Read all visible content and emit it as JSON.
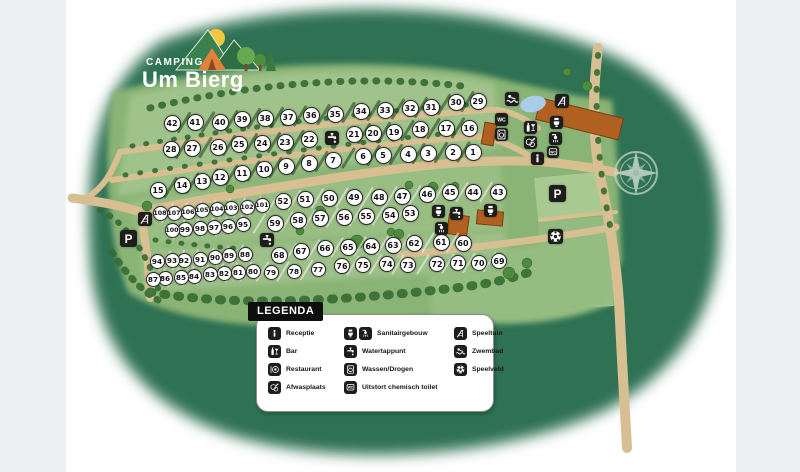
{
  "logo": {
    "camping": "CAMPING",
    "name": "Um Bierg"
  },
  "legend": {
    "title": "LEGENDA",
    "columns": [
      [
        {
          "icons": [
            "receptie"
          ],
          "label": "Receptie"
        },
        {
          "icons": [
            "bar"
          ],
          "label": "Bar"
        },
        {
          "icons": [
            "restaurant"
          ],
          "label": "Restaurant"
        },
        {
          "icons": [
            "afwasplaats"
          ],
          "label": "Afwasplaats"
        }
      ],
      [
        {
          "icons": [
            "toilet",
            "shower"
          ],
          "label": "Sanitairgebouw"
        },
        {
          "icons": [
            "watertappunt"
          ],
          "label": "Watertappunt"
        },
        {
          "icons": [
            "wassen"
          ],
          "label": "Wassen/Drogen"
        },
        {
          "icons": [
            "chemisch"
          ],
          "label": "Uitstort chemisch toilet"
        }
      ],
      [
        {
          "icons": [
            "speeltuin"
          ],
          "label": "Speeltuin"
        },
        {
          "icons": [
            "zwembad"
          ],
          "label": "Zwembad"
        },
        {
          "icons": [
            "speelveld"
          ],
          "label": "Speelveld"
        }
      ]
    ]
  },
  "colors": {
    "outer_green": "#2e7153",
    "field_green": "#8ab476",
    "road_tan": "#d7bf92",
    "building_orange": "#b06021",
    "pond_blue": "#a9cde6",
    "icon_black": "#1d1d1b"
  },
  "map": {
    "pitches": [
      {
        "n": 1,
        "x": 473,
        "y": 152
      },
      {
        "n": 2,
        "x": 453,
        "y": 152
      },
      {
        "n": 3,
        "x": 428,
        "y": 153
      },
      {
        "n": 4,
        "x": 408,
        "y": 154
      },
      {
        "n": 5,
        "x": 383,
        "y": 155
      },
      {
        "n": 6,
        "x": 363,
        "y": 156
      },
      {
        "n": 7,
        "x": 333,
        "y": 160
      },
      {
        "n": 8,
        "x": 309,
        "y": 163
      },
      {
        "n": 9,
        "x": 286,
        "y": 166
      },
      {
        "n": 10,
        "x": 264,
        "y": 169
      },
      {
        "n": 11,
        "x": 242,
        "y": 173
      },
      {
        "n": 12,
        "x": 220,
        "y": 177
      },
      {
        "n": 13,
        "x": 202,
        "y": 181
      },
      {
        "n": 14,
        "x": 182,
        "y": 185
      },
      {
        "n": 15,
        "x": 158,
        "y": 190
      },
      {
        "n": 16,
        "x": 469,
        "y": 128
      },
      {
        "n": 17,
        "x": 446,
        "y": 128
      },
      {
        "n": 18,
        "x": 420,
        "y": 129
      },
      {
        "n": 19,
        "x": 394,
        "y": 132
      },
      {
        "n": 20,
        "x": 373,
        "y": 133
      },
      {
        "n": 21,
        "x": 354,
        "y": 134
      },
      {
        "n": 22,
        "x": 309,
        "y": 139
      },
      {
        "n": 23,
        "x": 285,
        "y": 142
      },
      {
        "n": 24,
        "x": 262,
        "y": 143
      },
      {
        "n": 25,
        "x": 239,
        "y": 144
      },
      {
        "n": 26,
        "x": 218,
        "y": 147
      },
      {
        "n": 27,
        "x": 192,
        "y": 148
      },
      {
        "n": 28,
        "x": 171,
        "y": 149
      },
      {
        "n": 29,
        "x": 478,
        "y": 101
      },
      {
        "n": 30,
        "x": 456,
        "y": 102
      },
      {
        "n": 31,
        "x": 431,
        "y": 107
      },
      {
        "n": 32,
        "x": 410,
        "y": 108
      },
      {
        "n": 33,
        "x": 385,
        "y": 110
      },
      {
        "n": 34,
        "x": 361,
        "y": 111
      },
      {
        "n": 35,
        "x": 335,
        "y": 114
      },
      {
        "n": 36,
        "x": 311,
        "y": 115
      },
      {
        "n": 37,
        "x": 288,
        "y": 117
      },
      {
        "n": 38,
        "x": 265,
        "y": 118
      },
      {
        "n": 39,
        "x": 242,
        "y": 119
      },
      {
        "n": 40,
        "x": 220,
        "y": 122
      },
      {
        "n": 41,
        "x": 195,
        "y": 122
      },
      {
        "n": 42,
        "x": 172,
        "y": 123
      },
      {
        "n": 43,
        "x": 498,
        "y": 192
      },
      {
        "n": 44,
        "x": 473,
        "y": 192
      },
      {
        "n": 45,
        "x": 450,
        "y": 192
      },
      {
        "n": 46,
        "x": 427,
        "y": 194
      },
      {
        "n": 47,
        "x": 402,
        "y": 196
      },
      {
        "n": 48,
        "x": 379,
        "y": 197
      },
      {
        "n": 49,
        "x": 354,
        "y": 197
      },
      {
        "n": 50,
        "x": 329,
        "y": 198
      },
      {
        "n": 51,
        "x": 305,
        "y": 199
      },
      {
        "n": 52,
        "x": 283,
        "y": 201
      },
      {
        "n": 53,
        "x": 410,
        "y": 213
      },
      {
        "n": 54,
        "x": 390,
        "y": 215
      },
      {
        "n": 55,
        "x": 366,
        "y": 216
      },
      {
        "n": 56,
        "x": 344,
        "y": 217
      },
      {
        "n": 57,
        "x": 320,
        "y": 218
      },
      {
        "n": 58,
        "x": 298,
        "y": 220
      },
      {
        "n": 59,
        "x": 275,
        "y": 223
      },
      {
        "n": 60,
        "x": 463,
        "y": 243
      },
      {
        "n": 61,
        "x": 441,
        "y": 242
      },
      {
        "n": 62,
        "x": 414,
        "y": 243
      },
      {
        "n": 63,
        "x": 393,
        "y": 245
      },
      {
        "n": 64,
        "x": 371,
        "y": 246
      },
      {
        "n": 65,
        "x": 348,
        "y": 247
      },
      {
        "n": 66,
        "x": 325,
        "y": 248
      },
      {
        "n": 67,
        "x": 301,
        "y": 251
      },
      {
        "n": 68,
        "x": 279,
        "y": 255
      },
      {
        "n": 69,
        "x": 499,
        "y": 261
      },
      {
        "n": 70,
        "x": 479,
        "y": 263
      },
      {
        "n": 71,
        "x": 458,
        "y": 263
      },
      {
        "n": 72,
        "x": 437,
        "y": 264
      },
      {
        "n": 73,
        "x": 408,
        "y": 265
      },
      {
        "n": 74,
        "x": 387,
        "y": 264
      },
      {
        "n": 75,
        "x": 363,
        "y": 265
      },
      {
        "n": 76,
        "x": 342,
        "y": 266
      },
      {
        "n": 77,
        "x": 318,
        "y": 269
      },
      {
        "n": 78,
        "x": 294,
        "y": 271
      },
      {
        "n": 79,
        "x": 271,
        "y": 272
      },
      {
        "n": 80,
        "x": 253,
        "y": 271
      },
      {
        "n": 81,
        "x": 238,
        "y": 272
      },
      {
        "n": 82,
        "x": 224,
        "y": 273
      },
      {
        "n": 83,
        "x": 210,
        "y": 274
      },
      {
        "n": 84,
        "x": 194,
        "y": 276
      },
      {
        "n": 85,
        "x": 181,
        "y": 277
      },
      {
        "n": 86,
        "x": 165,
        "y": 278
      },
      {
        "n": 87,
        "x": 153,
        "y": 279
      },
      {
        "n": 88,
        "x": 245,
        "y": 254
      },
      {
        "n": 89,
        "x": 229,
        "y": 255
      },
      {
        "n": 90,
        "x": 215,
        "y": 257
      },
      {
        "n": 91,
        "x": 200,
        "y": 259
      },
      {
        "n": 92,
        "x": 184,
        "y": 260
      },
      {
        "n": 93,
        "x": 172,
        "y": 260
      },
      {
        "n": 94,
        "x": 157,
        "y": 261
      },
      {
        "n": 95,
        "x": 243,
        "y": 224
      },
      {
        "n": 96,
        "x": 228,
        "y": 226
      },
      {
        "n": 97,
        "x": 214,
        "y": 227
      },
      {
        "n": 98,
        "x": 200,
        "y": 228
      },
      {
        "n": 99,
        "x": 185,
        "y": 229
      },
      {
        "n": 100,
        "x": 172,
        "y": 230
      },
      {
        "n": 101,
        "x": 262,
        "y": 205
      },
      {
        "n": 102,
        "x": 247,
        "y": 207
      },
      {
        "n": 103,
        "x": 231,
        "y": 208
      },
      {
        "n": 104,
        "x": 217,
        "y": 209
      },
      {
        "n": 105,
        "x": 202,
        "y": 210
      },
      {
        "n": 106,
        "x": 188,
        "y": 212
      },
      {
        "n": 107,
        "x": 174,
        "y": 213
      },
      {
        "n": 108,
        "x": 160,
        "y": 213
      }
    ],
    "icons": [
      {
        "type": "speeltuin",
        "x": 145,
        "y": 219,
        "size": 14
      },
      {
        "type": "parking",
        "x": 128,
        "y": 238,
        "size": 17
      },
      {
        "type": "watertappunt",
        "x": 267,
        "y": 240,
        "size": 14
      },
      {
        "type": "watertappunt",
        "x": 332,
        "y": 138,
        "size": 14
      },
      {
        "type": "wc",
        "x": 501,
        "y": 119,
        "size": 13
      },
      {
        "type": "wassen",
        "x": 501,
        "y": 134,
        "size": 13
      },
      {
        "type": "zwembad",
        "x": 512,
        "y": 99,
        "size": 14
      },
      {
        "type": "speeltuin",
        "x": 562,
        "y": 101,
        "size": 14
      },
      {
        "type": "bar",
        "x": 530,
        "y": 127,
        "size": 13
      },
      {
        "type": "afwasplaats",
        "x": 530,
        "y": 142,
        "size": 13
      },
      {
        "type": "toilet",
        "x": 556,
        "y": 122,
        "size": 13
      },
      {
        "type": "shower",
        "x": 555,
        "y": 138,
        "size": 13
      },
      {
        "type": "chemisch",
        "x": 553,
        "y": 152,
        "size": 12
      },
      {
        "type": "receptie",
        "x": 537,
        "y": 158,
        "size": 13
      },
      {
        "type": "toilet",
        "x": 438,
        "y": 211,
        "size": 13
      },
      {
        "type": "watertappunt",
        "x": 456,
        "y": 213,
        "size": 13
      },
      {
        "type": "shower",
        "x": 441,
        "y": 228,
        "size": 13
      },
      {
        "type": "toilet",
        "x": 490,
        "y": 210,
        "size": 13
      },
      {
        "type": "parking",
        "x": 557,
        "y": 193,
        "size": 17
      },
      {
        "type": "speelveld",
        "x": 555,
        "y": 236,
        "size": 15
      }
    ],
    "rows_dark": [
      [
        42,
        41,
        40,
        39,
        38,
        37,
        36,
        35,
        34,
        33,
        32,
        31,
        30,
        29
      ],
      [
        28,
        27,
        26,
        25,
        24,
        23,
        22,
        21,
        20,
        19,
        18,
        17,
        16
      ],
      [
        15,
        14,
        13,
        12,
        11,
        10,
        9,
        8,
        7,
        6,
        5,
        4,
        3,
        2,
        1
      ]
    ],
    "rows_light": [
      [
        108,
        107,
        106,
        105,
        104,
        103,
        102,
        101,
        52,
        51,
        50,
        49,
        48,
        47,
        46,
        45,
        44,
        43
      ],
      [
        100,
        99,
        98,
        97,
        96,
        95,
        59,
        58,
        57,
        56,
        55,
        54,
        53
      ],
      [
        68,
        67,
        66,
        65,
        64,
        63,
        62,
        61,
        60
      ],
      [
        94,
        93,
        92,
        91,
        90,
        89,
        88
      ],
      [
        87,
        86,
        85,
        84,
        83,
        82,
        81,
        80,
        79,
        78,
        77
      ],
      [
        76,
        75,
        74,
        73,
        72,
        71,
        70,
        69
      ]
    ]
  }
}
